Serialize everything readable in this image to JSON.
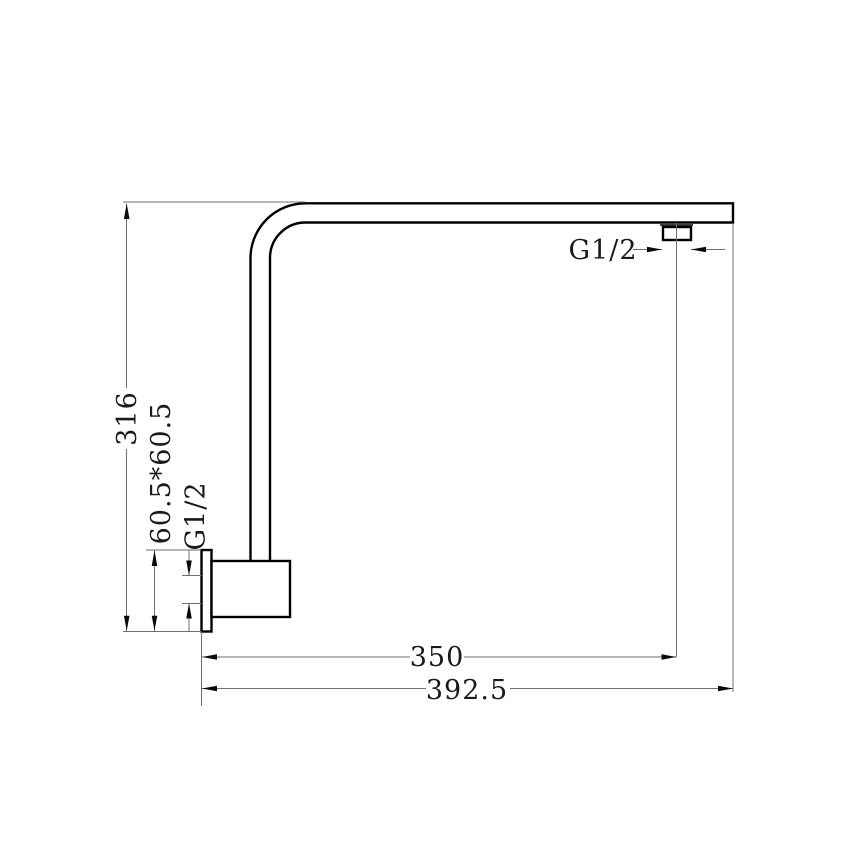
{
  "drawing": {
    "subject": "shower-arm-side-view-technical-drawing",
    "colors": {
      "background": "#ffffff",
      "object_line": "#000000",
      "dimension_line": "#6f6f6f",
      "text": "#1a1a1a"
    },
    "dims": {
      "height": {
        "label": "316",
        "orientation": "vertical"
      },
      "flange": {
        "label": "60.5*60.5",
        "orientation": "vertical"
      },
      "wall_thread": {
        "label": "G1/2",
        "orientation": "vertical"
      },
      "outlet_thread": {
        "label": "G1/2",
        "orientation": "horizontal"
      },
      "outlet_center": {
        "label": "350",
        "orientation": "horizontal"
      },
      "overall": {
        "label": "392.5",
        "orientation": "horizontal"
      }
    }
  }
}
